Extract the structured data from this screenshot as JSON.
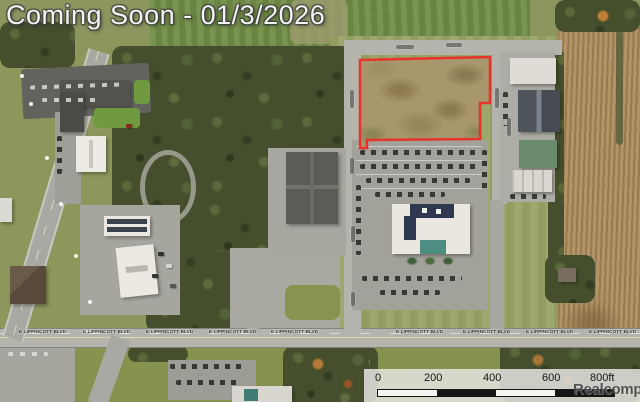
{
  "banner": {
    "text": "Coming Soon - 01/3/2026"
  },
  "map": {
    "lippincott_label": "E LIPPINCOTT BLVD",
    "parcel": {
      "outline_color": "#e8332a"
    }
  },
  "scale_bar": {
    "ticks": [
      "0",
      "200",
      "400",
      "600",
      "800ft"
    ],
    "watermark": "Realcomp"
  },
  "colors": {
    "banner_text": "#f3f3f1",
    "scale_text": "#141414"
  }
}
